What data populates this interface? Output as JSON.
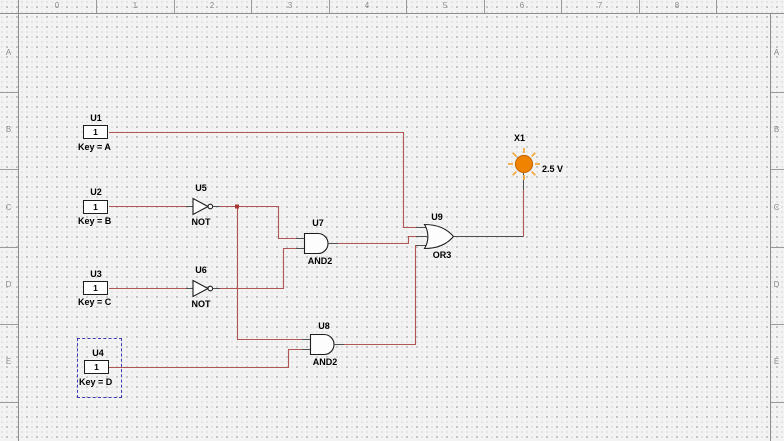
{
  "app": {
    "view": "schematic-capture-canvas"
  },
  "rulers": {
    "top_numbers": [
      "0",
      "1",
      "2",
      "3",
      "4",
      "5",
      "6",
      "7",
      "8"
    ],
    "row_letters": [
      "A",
      "B",
      "C",
      "D",
      "E"
    ]
  },
  "switches": [
    {
      "ref": "U1",
      "value": "1",
      "key": "Key = A",
      "selected": false
    },
    {
      "ref": "U2",
      "value": "1",
      "key": "Key = B",
      "selected": false
    },
    {
      "ref": "U3",
      "value": "1",
      "key": "Key = C",
      "selected": false
    },
    {
      "ref": "U4",
      "value": "1",
      "key": "Key = D",
      "selected": true
    }
  ],
  "gates": [
    {
      "ref": "U5",
      "type": "NOT"
    },
    {
      "ref": "U6",
      "type": "NOT"
    },
    {
      "ref": "U7",
      "type": "AND2"
    },
    {
      "ref": "U8",
      "type": "AND2"
    },
    {
      "ref": "U9",
      "type": "OR3"
    }
  ],
  "probe": {
    "ref": "X1",
    "value": "2.5 V"
  },
  "colors": {
    "wire": "#b25555",
    "lead": "#4f4f4f",
    "junction": "#a83434",
    "selection": "#3b3bb8",
    "probe-fill": "#f08400",
    "probe-stroke": "#c96a00",
    "probe-ray": "#f5a93e"
  }
}
